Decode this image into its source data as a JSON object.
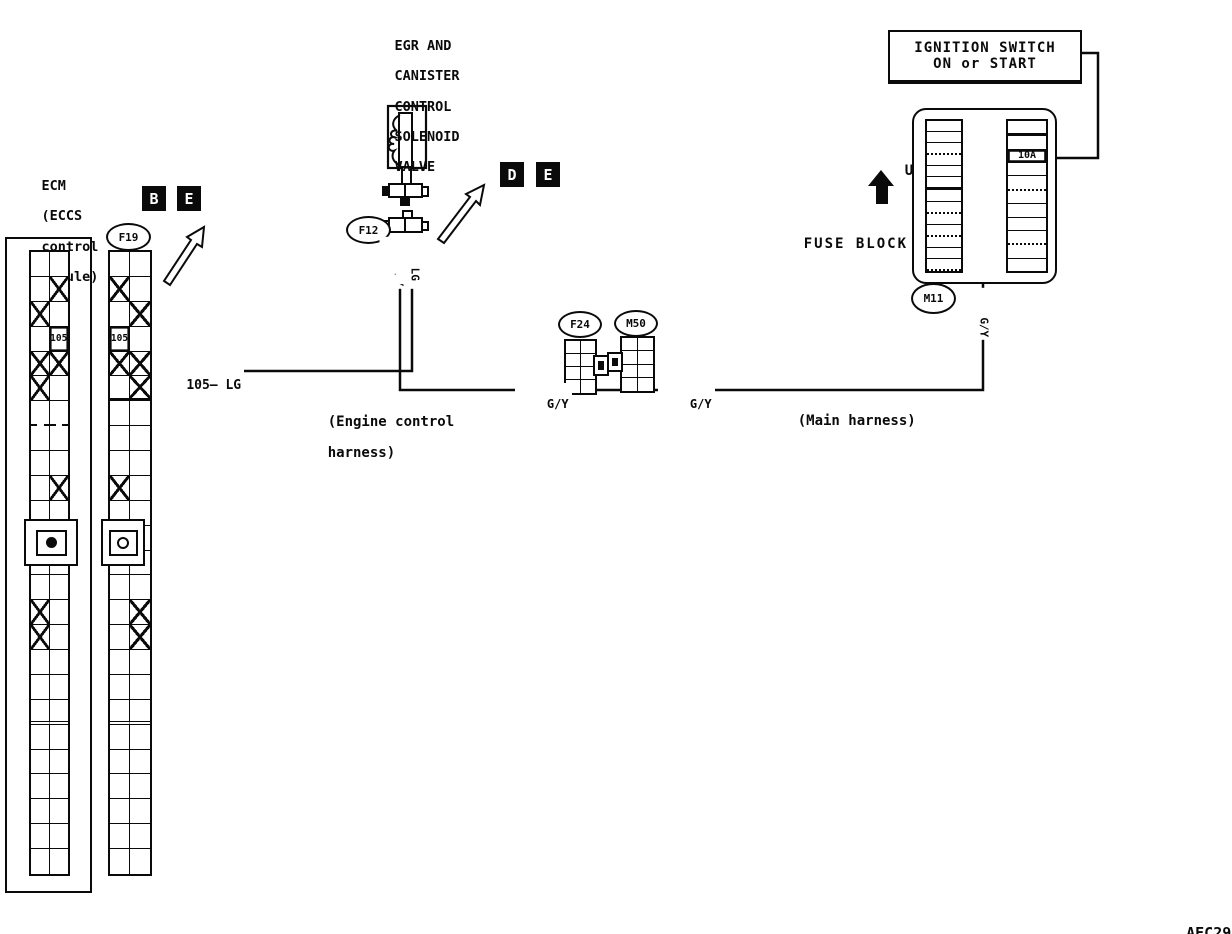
{
  "doc_code": "AEC293",
  "ecm": {
    "label_lines": [
      "ECM",
      "(ECCS",
      "control",
      "module)"
    ],
    "terminal": "105"
  },
  "f19_connector": {
    "id": "F19",
    "terminal": "105"
  },
  "view_refs": {
    "ecm_pair": [
      "B",
      "E"
    ],
    "valve_pair": [
      "D",
      "E"
    ]
  },
  "valve": {
    "label_lines": [
      "EGR AND",
      "CANISTER",
      "CONTROL",
      "SOLENOID",
      "VALVE"
    ],
    "connector": "F12"
  },
  "power": {
    "label_lines": [
      "IGNITION SWITCH",
      "ON or START"
    ]
  },
  "fuse_block": {
    "label": "FUSE BLOCK",
    "up_label": "UP",
    "connector": "M11",
    "fuse_rating": "10A",
    "left_rows": 13,
    "right_rows": 11,
    "fuse_row_index": 2
  },
  "inline_connectors": {
    "left": "F24",
    "right": "M50"
  },
  "wire_labels": {
    "ecm_to_valve": "105— LG",
    "valve_gy": "G/Y",
    "valve_lg": "LG",
    "before_f24": "G/Y",
    "after_m50": "G/Y",
    "to_fuse": "G/Y"
  },
  "harness_notes": {
    "engine_lines": [
      "(Engine control",
      "harness)"
    ],
    "main": "(Main harness)"
  },
  "strip_patterns": {
    "rows": 25,
    "ecm_rows": [
      "",
      "R",
      "L",
      "NR",
      "LR",
      "L",
      "",
      "",
      "",
      "R",
      "",
      "",
      "",
      "",
      "L",
      "L",
      "",
      "",
      "",
      "",
      "",
      "",
      "",
      "",
      ""
    ],
    "f19_rows": [
      "",
      "L",
      "R",
      "NL",
      "LR",
      "R",
      "",
      "",
      "",
      "L",
      "",
      "",
      "",
      "",
      "R",
      "R",
      "",
      "",
      "",
      "",
      "",
      "",
      "",
      "",
      ""
    ]
  },
  "colors": {
    "ink": "#0a0a0a",
    "paper": "#ffffff"
  }
}
